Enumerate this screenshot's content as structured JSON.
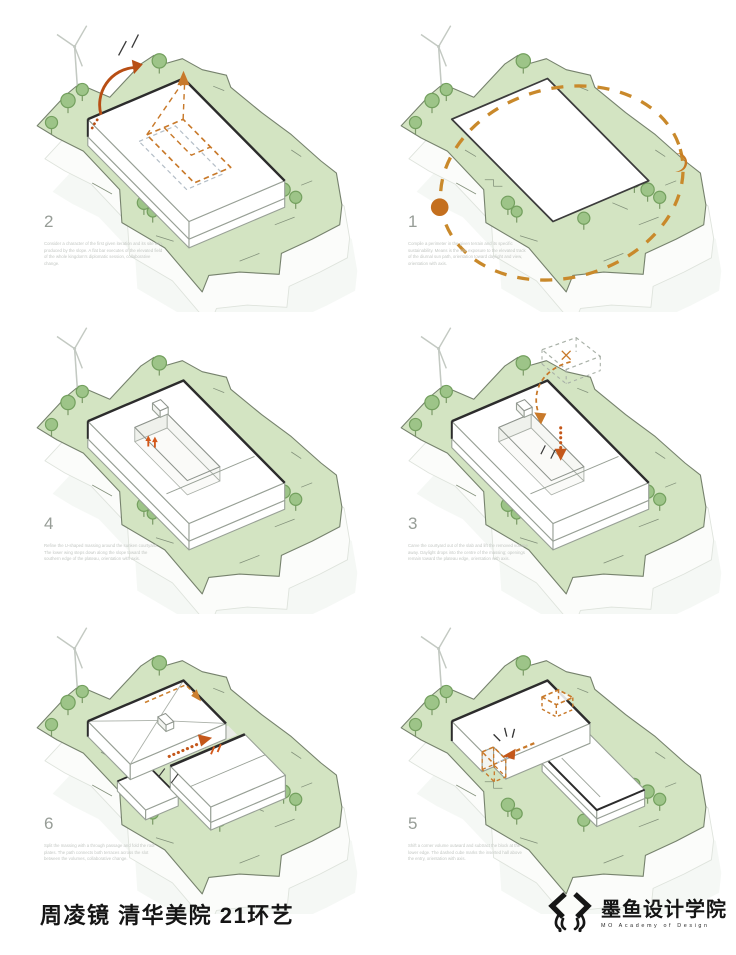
{
  "colors": {
    "terrain_green": "#d3e4c2",
    "terrain_edge": "#76826d",
    "tree_green": "#9dc488",
    "tree_edge": "#74a05f",
    "building_white": "#ffffff",
    "line_thin": "#98a096",
    "line_heavy": "#2c2c2c",
    "accent_orange": "#c8792a",
    "accent_orange_strong": "#c4571a",
    "blue_gray_dash": "#b4bec7",
    "shadow": "#f2f5f1",
    "caption_gray": "#c3c7c3",
    "number_gray": "#979d97"
  },
  "panels": [
    {
      "step": "step-2",
      "number": "2",
      "caption": "Consider a character of the first given iteration and its site info, produced by the slope. A flat bar executes of the elevated field of the whole kingdom's diplomatic session, collaborative change.",
      "annotations": [
        "rotation-arrow",
        "courtyard-preview-dashed",
        "projection-rays",
        "wind-turbine-icon",
        "tree-icon"
      ]
    },
    {
      "step": "step-1",
      "number": "1",
      "caption": "Compile a perimeter in the given terrain and its specific sustainability. Means is the site exposure to the elevated track of the diurnal sun path, orientation toward daylight and view, orientation with axis.",
      "annotations": [
        "sun-path-ellipse",
        "sun-icon",
        "moon-icon",
        "wind-turbine-icon",
        "tree-icon"
      ]
    },
    {
      "step": "step-4",
      "number": "4",
      "caption": "Refine the U-shaped massing around the sunken courtyard. The lower wing steps down along the slope toward the southern edge of the plateau, orientation with axis.",
      "annotations": [
        "entry-arrows-up",
        "wind-turbine-icon",
        "tree-icon"
      ]
    },
    {
      "step": "step-3",
      "number": "3",
      "caption": "Carve the courtyard out of the slab and lift the removed volume away. Daylight drops into the centre of the massing; openings remain toward the plateau edge, orientation with axis.",
      "annotations": [
        "removed-volume-dashed",
        "drop-arrow",
        "trajectory-arc",
        "wind-turbine-icon",
        "tree-icon"
      ]
    },
    {
      "step": "step-6",
      "number": "6",
      "caption": "Split the massing with a through passage and fold the roof plates. The path connects both terraces across the slot between the volumes, collaborative change.",
      "annotations": [
        "passage-arrow",
        "roof-fold-dashed",
        "wind-turbine-icon",
        "tree-icon"
      ]
    },
    {
      "step": "step-5",
      "number": "5",
      "caption": "Shift a corner volume outward and subtract the block at the lower edge. The dashed cube marks the inserted hall above the entry, orientation with axis.",
      "annotations": [
        "inserted-cube-dashed",
        "shift-arrow",
        "corner-subtraction-dashed",
        "wind-turbine-icon",
        "tree-icon"
      ]
    }
  ],
  "footer": {
    "title": "周凌镜 清华美院 21环艺",
    "logo_text": "墨鱼设计学院",
    "logo_subtext": "MO Academy of Design",
    "logo_icon": "squid-logo-icon"
  }
}
